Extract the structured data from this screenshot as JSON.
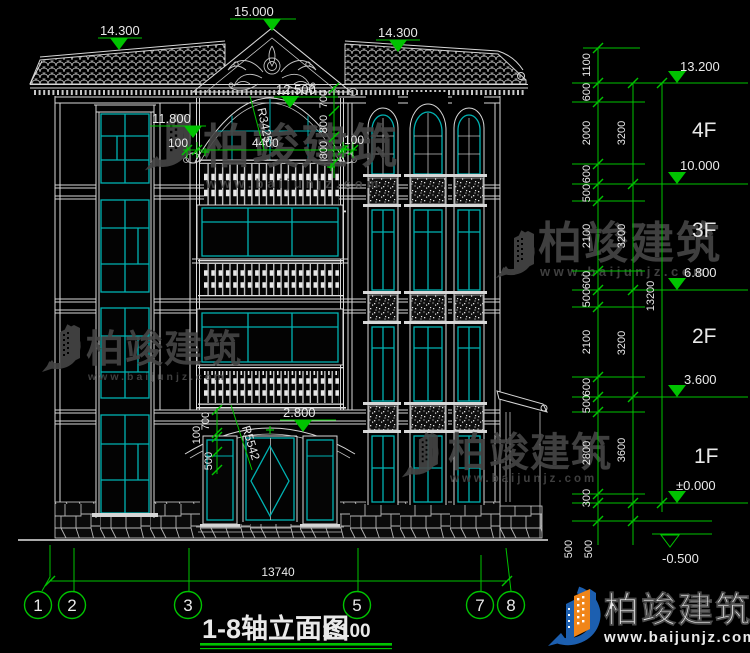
{
  "title": {
    "name": "1-8轴立面图",
    "scale": "1:100"
  },
  "top_markers": {
    "left": "14.300",
    "center": "15.000",
    "right": "14.300"
  },
  "facade": {
    "gable_elev": "12.500",
    "arch_elev": "11.800",
    "balcony_width": "4400",
    "balcony_side": "100",
    "arch_radius": "R3425",
    "upper_chain": [
      "700",
      "800",
      "800"
    ],
    "entry_elev": "2.800",
    "entry_chain": [
      "700",
      "100",
      "500"
    ],
    "entry_radius": "R5542"
  },
  "right_dims": {
    "chain1": [
      "1100",
      "600",
      "2000",
      "600",
      "500",
      "2100",
      "600",
      "500",
      "2100",
      "600",
      "500",
      "2800",
      "300",
      "500"
    ],
    "chain2": [
      "3200",
      "3200",
      "3200",
      "3600",
      "500"
    ],
    "total": "13200",
    "levels": [
      {
        "label": "13.200",
        "floor": "4F"
      },
      {
        "label": "10.000",
        "floor": "3F"
      },
      {
        "label": "6.800",
        "floor": "2F"
      },
      {
        "label": "3.600",
        "floor": "1F"
      },
      {
        "label": "±0.000"
      },
      {
        "label": "-0.500"
      }
    ]
  },
  "bottom": {
    "overall": "13740",
    "axes": [
      "1",
      "2",
      "3",
      "5",
      "7",
      "8"
    ]
  },
  "watermark": {
    "brand": "柏竣建筑",
    "url": "www.baijunjz.com"
  },
  "logo": {
    "brand": "柏竣建筑",
    "url": "www.baijunjz.com"
  },
  "colors": {
    "background": "#000000",
    "drawing_line": "#d7d7d7",
    "glass_cyan": "#00b2b2",
    "dimension_green": "#00c300",
    "watermark_grey": "#474747",
    "logo_blue": "#1c5fb0",
    "logo_orange": "#f08519"
  }
}
